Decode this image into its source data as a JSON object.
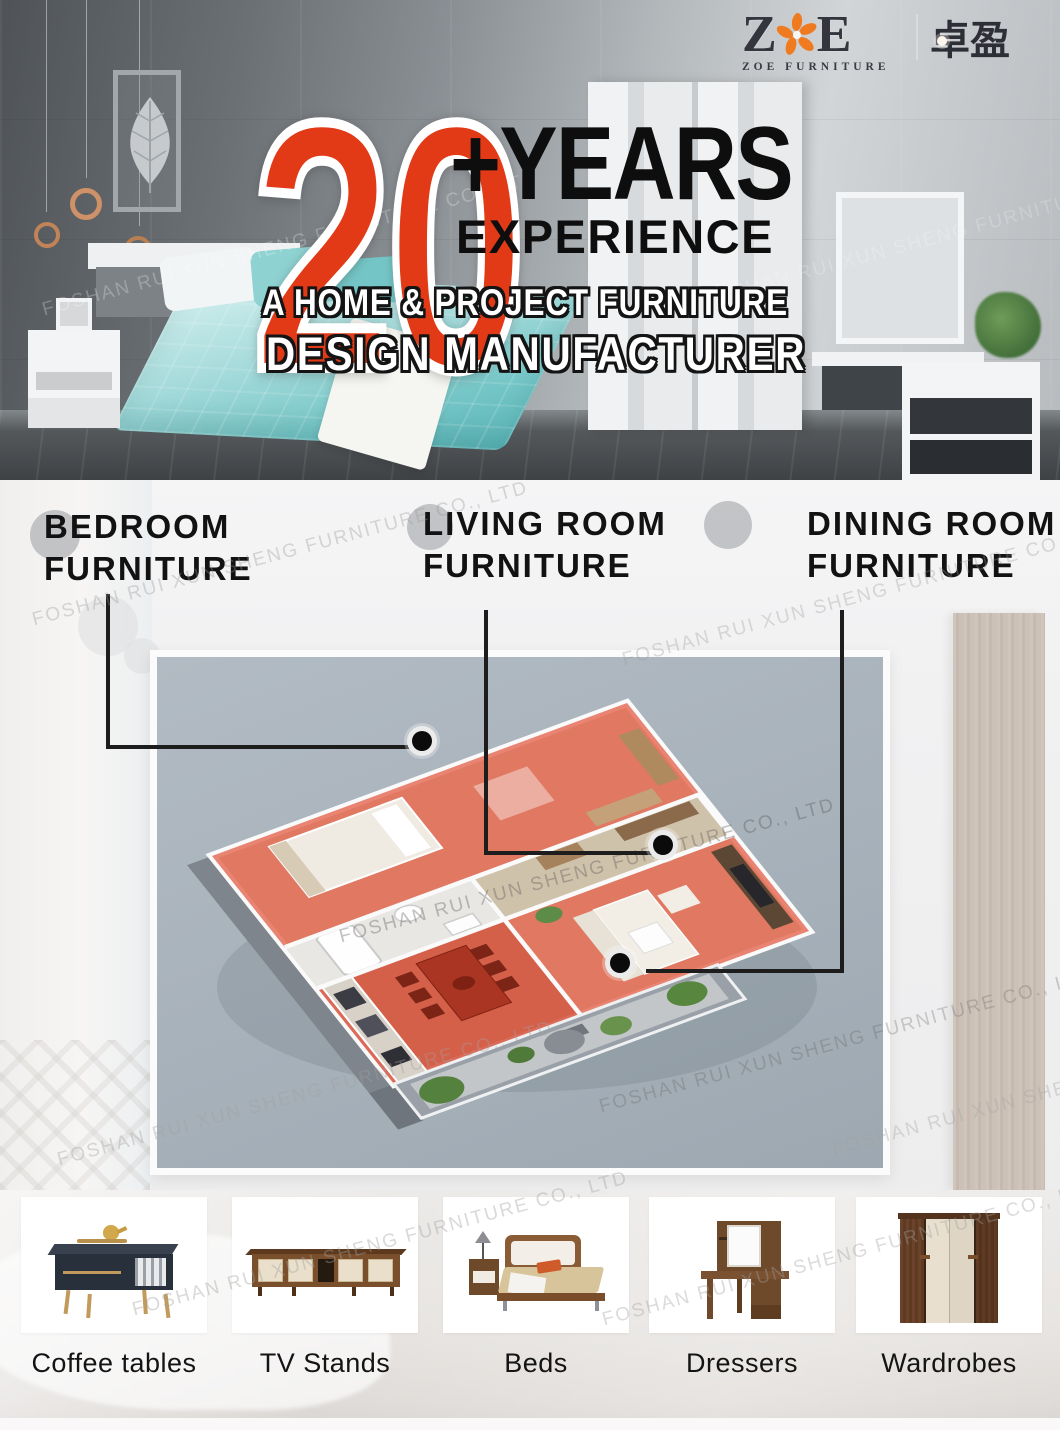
{
  "watermark": "FOSHAN RUI XUN SHENG FURNITURE CO., LTD",
  "logo": {
    "letter_z": "Z",
    "letter_e": "E",
    "flower_icon": "orange-flower",
    "subtitle": "ZOE  FURNITURE",
    "cn_left": "卓",
    "cn_right": "盈"
  },
  "hero": {
    "number": "20",
    "plus_years": "+YEARS",
    "experience": "EXPERIENCE",
    "tagline1": "A HOME & PROJECT FURNITURE",
    "tagline2": "DESIGN MANUFACTURER"
  },
  "rooms": [
    {
      "line1": "BEDROOM",
      "line2": "FURNITURE"
    },
    {
      "line1": "LIVING ROOM",
      "line2": "FURNITURE"
    },
    {
      "line1": "DINING ROOM",
      "line2": "FURNITURE"
    }
  ],
  "categories": [
    {
      "label": "Coffee tables"
    },
    {
      "label": "TV Stands"
    },
    {
      "label": "Beds"
    },
    {
      "label": "Dressers"
    },
    {
      "label": "Wardrobes"
    }
  ],
  "colors": {
    "accent_red": "#e23a17",
    "room_highlight": "#e2604a",
    "dining_highlight": "#d64a34",
    "logo_orange": "#ef7a1f"
  }
}
